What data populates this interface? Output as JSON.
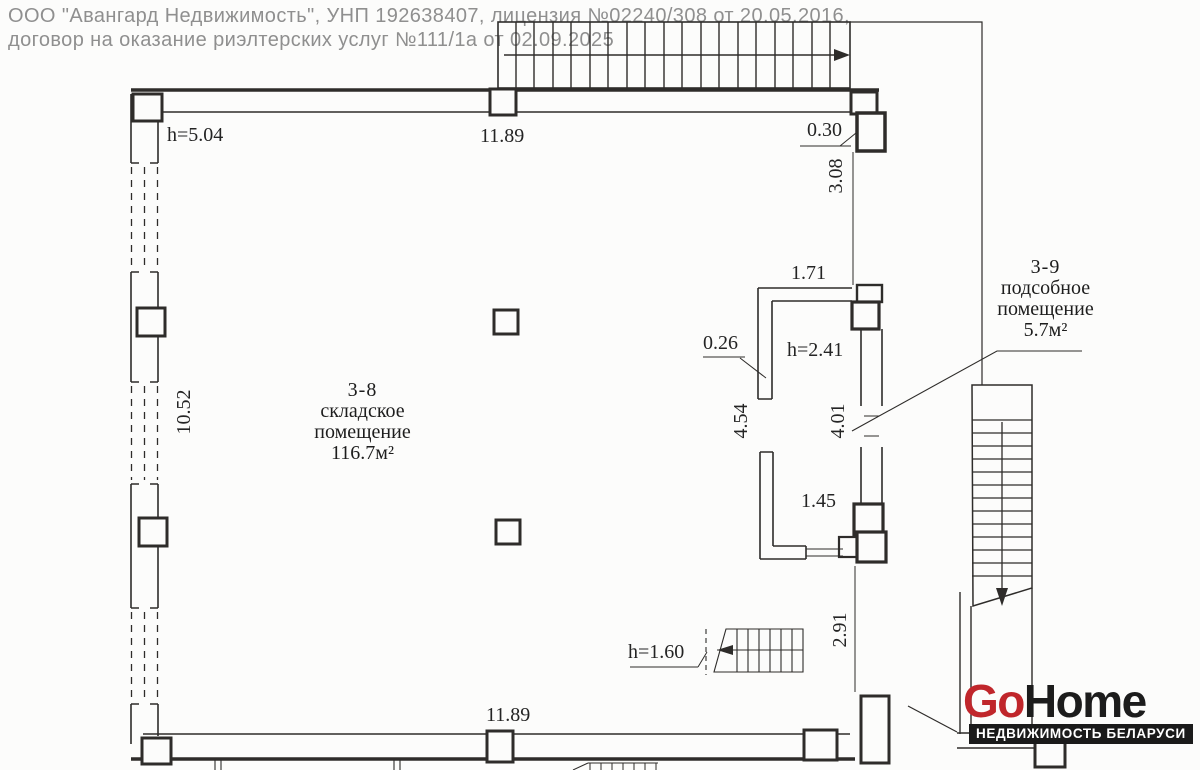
{
  "header": {
    "line1": "ООО \"Авангард Недвижимость\", УНП 192638407, лицензия №02240/308 от 20.05.2016,",
    "line2": "договор на оказание риэлтерских услуг №111/1а от 02.09.2025"
  },
  "rooms": {
    "storage": {
      "number": "3-8",
      "type_line1": "складское",
      "type_line2": "помещение",
      "area": "116.7м²"
    },
    "utility": {
      "number": "3-9",
      "type_line1": "подсобное",
      "type_line2": "помещение",
      "area": "5.7м²"
    }
  },
  "dimensions": {
    "ceiling_height_main": "h=5.04",
    "top_width": "11.89",
    "wall_offset": "0.30",
    "right_upper": "3.08",
    "inner_top_width": "1.71",
    "inner_wall_thickness": "0.26",
    "ceiling_height_inner": "h=2.41",
    "inner_left_height": "4.54",
    "inner_right_height": "4.01",
    "inner_bottom_width": "1.45",
    "left_height": "10.52",
    "stair_headroom": "h=1.60",
    "lower_right": "2.91",
    "bottom_width": "11.89"
  },
  "logo": {
    "go": "Go",
    "home": "Home",
    "tagline": "НЕДВИЖИМОСТЬ БЕЛАРУСИ",
    "accent_color": "#c0262b",
    "text_color": "#1c1c1c"
  }
}
